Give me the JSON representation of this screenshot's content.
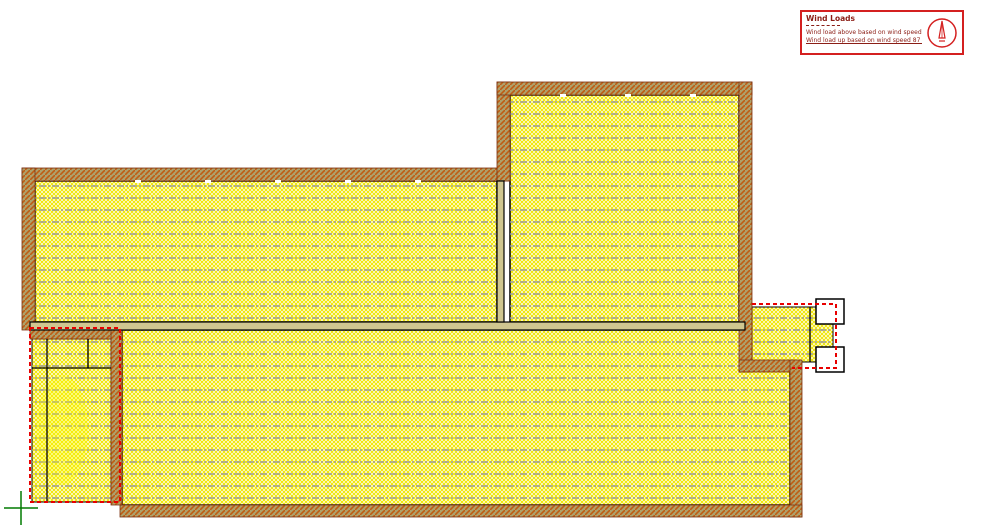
{
  "legend": {
    "title": "Wind Loads",
    "notes": [
      "Wind load above based on wind speed 87 m/s.",
      "Wind load up based on wind speed 87 m/s."
    ]
  },
  "icons": {
    "north_arrow": "obelisk-north-arrow-in-circle",
    "origin_marker": "green-cross-origin-marker"
  },
  "colors": {
    "legend_border": "#d42020",
    "legend_text": "#8b1d15",
    "wall_fill": "#aea06a",
    "wall_hatch_orange": "#bf5c14",
    "wall_edge_maroon": "#7a3010",
    "interior_bg": "#fffdf0",
    "interior_hatch_yellow": "#f0e600",
    "joist_line_gray": "#9a9a9a",
    "interior_wall_fill": "#cfc690",
    "partition_black": "#000000",
    "red_dashed_line": "#e80000",
    "origin_cross_green": "#007a00"
  },
  "plan": {
    "regions": [
      "upper-left-roof-area",
      "upper-right-roof-area",
      "lower-roof-area",
      "bottom-left-room",
      "right-bump-out"
    ]
  }
}
